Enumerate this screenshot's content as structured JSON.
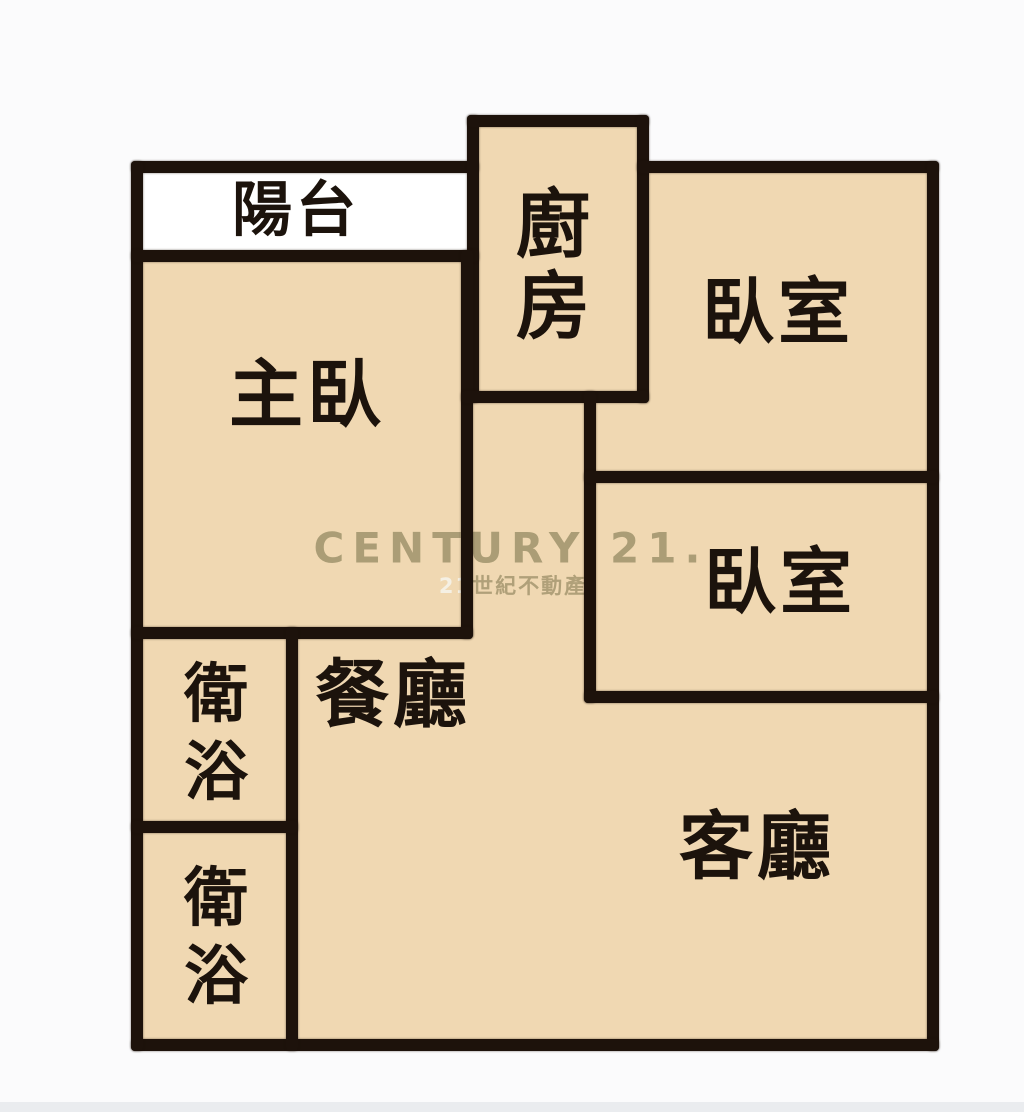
{
  "watermark": {
    "brand": "CENTURY 21.",
    "subtitle_prefix": "21",
    "subtitle_rest": "世紀不動產"
  },
  "rooms": {
    "balcony": {
      "name": "陽台"
    },
    "kitchen": {
      "name": "廚房",
      "char1": "廚",
      "char2": "房"
    },
    "bedroom_top_right": {
      "name": "臥室"
    },
    "master_bedroom": {
      "name": "主臥"
    },
    "bedroom_middle_right": {
      "name": "臥室"
    },
    "dining_room": {
      "name": "餐廳"
    },
    "bathroom_upper": {
      "name": "衛浴",
      "char1": "衛",
      "char2": "浴"
    },
    "bathroom_lower": {
      "name": "衛浴",
      "char1": "衛",
      "char2": "浴"
    },
    "living_room": {
      "name": "客廳"
    }
  },
  "colors": {
    "floor_fill": "#f0d8b2",
    "wall": "#1d120b",
    "balcony_fill": "#ffffff",
    "background": "#fbfbfc",
    "watermark": "#948961"
  }
}
